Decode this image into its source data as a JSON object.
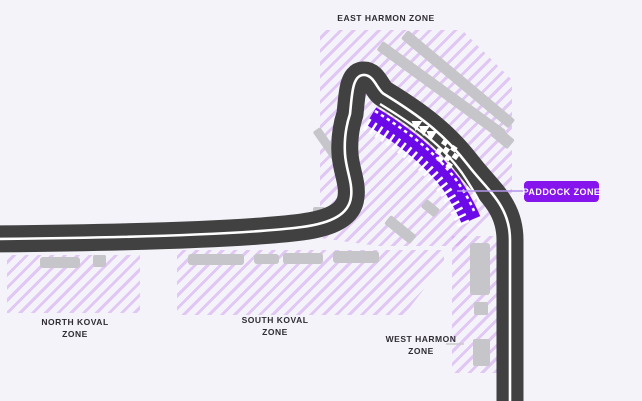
{
  "title": "Circuit zone map",
  "colors": {
    "bg": "#f5f3fa",
    "hatch": "#cfa3ef",
    "road": "#414141",
    "road-line": "#ffffff",
    "building": "#c6c5c9",
    "strip": "#6c09e9",
    "accent": "#8614ed",
    "label-text": "#2e2b33",
    "leader-gray": "#c9c9c9",
    "leader-purple": "#b495ea"
  },
  "zones": {
    "east_harmon": {
      "label": "EAST HARMON ZONE"
    },
    "north_koval": {
      "line1": "NORTH KOVAL",
      "line2": "ZONE"
    },
    "south_koval": {
      "line1": "SOUTH KOVAL",
      "line2": "ZONE"
    },
    "west_harmon": {
      "line1": "WEST HARMON",
      "line2": "ZONE"
    },
    "paddock": {
      "label": "PADDOCK ZONE"
    }
  },
  "icons": {
    "direction_chevrons": "three white chevrons pointing up-left along track",
    "start_finish": "checkered start-finish band across track"
  }
}
